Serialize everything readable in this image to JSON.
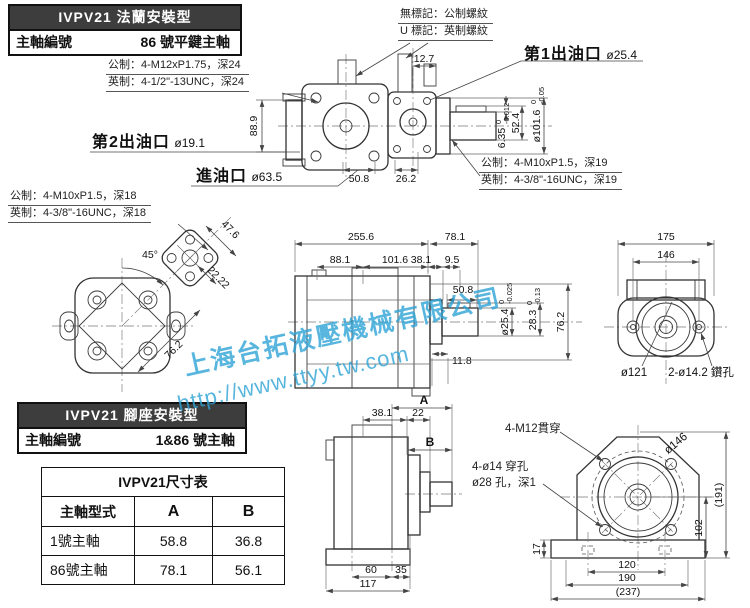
{
  "flange_block": {
    "title": "IVPV21 法蘭安裝型",
    "label": "主軸編號",
    "value": "86 號平鍵主軸"
  },
  "foot_block": {
    "title": "IVPV21 腳座安裝型",
    "label": "主軸編號",
    "value": "1&86 號主軸"
  },
  "thread_note": {
    "line1": "無標記：公制螺紋",
    "line2": "U 標記：英制螺紋"
  },
  "notes": {
    "flange_metric": "公制：4-M12xP1.75，深24",
    "flange_inch": "英制：4-1/2\"-13UNC，深24",
    "outlet_metric": "公制：4-M10xP1.5，深19",
    "outlet_inch": "英制：4-3/8\"-16UNC，深19",
    "rear_metric": "公制：4-M10xP1.5，深18",
    "rear_inch": "英制：4-3/8\"-16UNC，深18"
  },
  "ports": {
    "outlet1_label": "第1出油口",
    "outlet1_dia": "ø25.4",
    "outlet2_label": "第2出油口",
    "outlet2_dia": "ø19.1",
    "inlet_label": "進油口",
    "inlet_dia": "ø63.5"
  },
  "top_view": {
    "dims": {
      "port_offset": "12.7",
      "height": "88.9",
      "w1": "50.8",
      "w2": "26.2",
      "len": "52.4",
      "key": {
        "main": "6.35",
        "up": "0",
        "dn": "-0.012"
      },
      "pilot": {
        "main": "ø101.6",
        "up": "0",
        "dn": "-0.05"
      }
    }
  },
  "side_view": {
    "dims": {
      "total": "255.6",
      "shaft_ext": "78.1",
      "a": "88.1",
      "b": "101.6",
      "c": "38.1",
      "d": "9.5",
      "shaft_len": "50.8",
      "step": "11.8",
      "height": "76.2",
      "shaft_dia": {
        "main": "ø25.4",
        "up": "0",
        "dn": "-0.025"
      },
      "key_h": {
        "main": "28.3",
        "up": "0",
        "dn": "-0.13"
      }
    }
  },
  "rear_view": {
    "dims": {
      "angle": "45°",
      "plate": "47.6",
      "plate_half": "22.22",
      "body": "76.2"
    }
  },
  "flange_view": {
    "dims": {
      "width": "175",
      "bolt_span": "146"
    },
    "labels": {
      "pilot": "ø121",
      "holes": "2-ø14.2 鑽孔"
    }
  },
  "foot_side": {
    "dims": {
      "a": "A",
      "d1": "38.1",
      "d2": "22",
      "b": "B",
      "f1": "60",
      "f2": "35",
      "f3": "117"
    }
  },
  "foot_front": {
    "labels": {
      "bolts": "4-M12貫穿",
      "holes": "4-ø14 穿孔",
      "cbore": "ø28 孔，深1",
      "bc": "ø146"
    },
    "dims": {
      "h_total": "(191)",
      "h1": "102",
      "base": "17",
      "b1": "120",
      "b2": "190",
      "b3": "(237)"
    }
  },
  "size_table": {
    "title": "IVPV21尺寸表",
    "col_type": "主軸型式",
    "col_a": "A",
    "col_b": "B",
    "rows": [
      {
        "name": "1號主軸",
        "a": "58.8",
        "b": "36.8"
      },
      {
        "name": "86號主軸",
        "a": "78.1",
        "b": "56.1"
      }
    ]
  },
  "watermark": {
    "line1": "上海台拓液壓機械有限公司",
    "line2": "http://www.ttyy.tw.com",
    "color": "#2ea3d6"
  }
}
